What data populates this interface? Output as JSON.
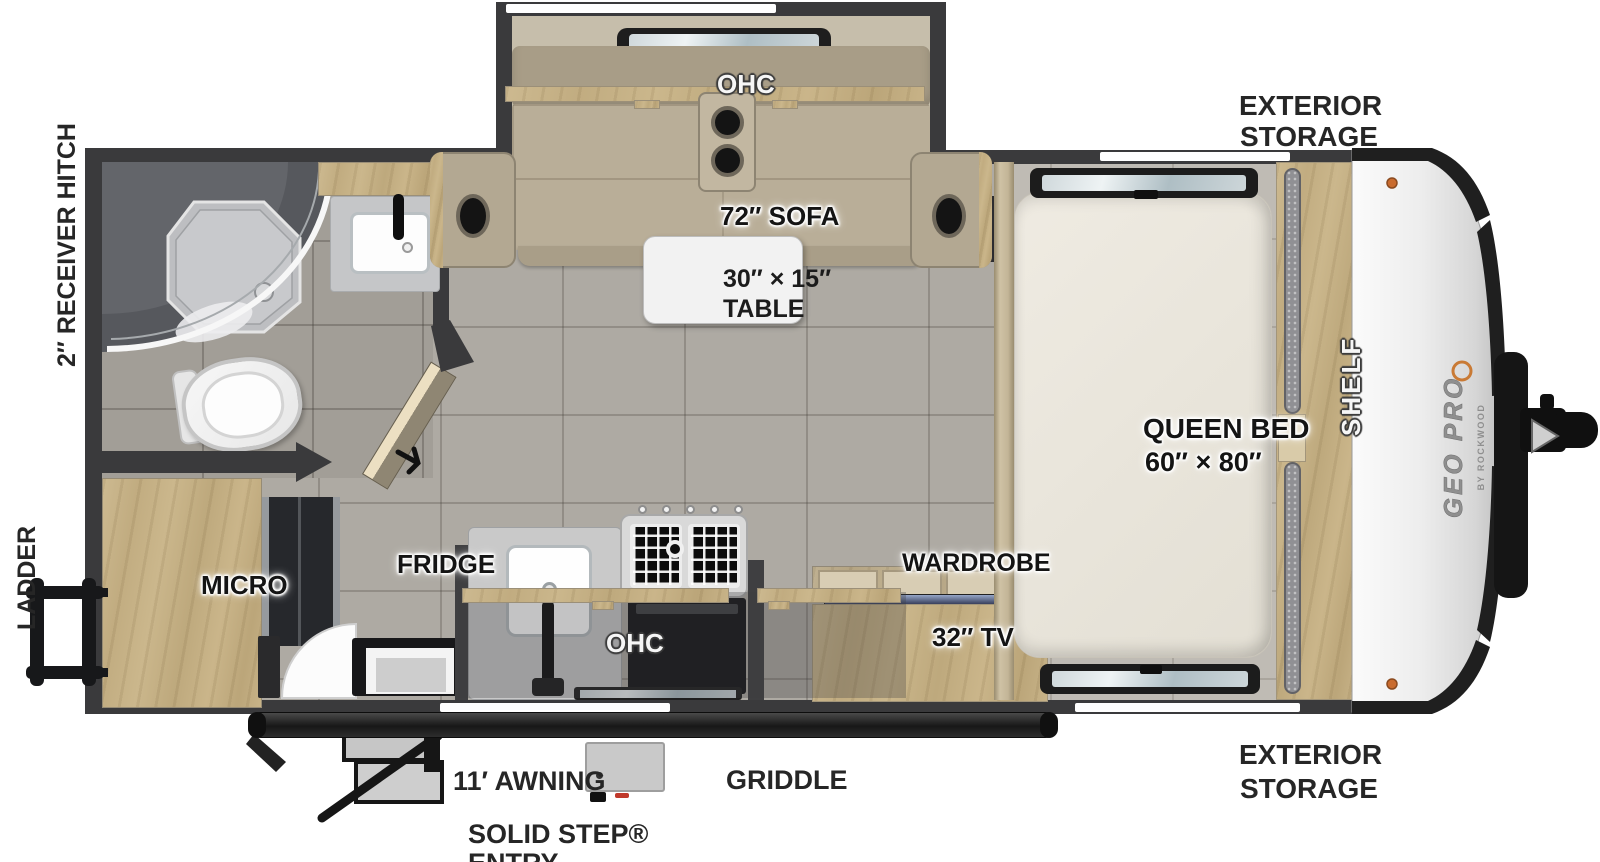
{
  "brand": {
    "name": "GEO PRO",
    "sub": "BY ROCKWOOD"
  },
  "exterior_labels": {
    "storage_top_1": "EXTERIOR",
    "storage_top_2": "STORAGE",
    "storage_bottom_1": "EXTERIOR",
    "storage_bottom_2": "STORAGE",
    "receiver_hitch": "2″ RECEIVER HITCH",
    "ladder": "LADDER",
    "awning": "11′ AWNING",
    "solid_step_1": "SOLID STEP®",
    "solid_step_2": "ENTRY",
    "griddle": "GRIDDLE"
  },
  "interior_labels": {
    "ohc_sofa": "OHC",
    "sofa": "72″ SOFA",
    "table_1": "30″ × 15″",
    "table_2": "TABLE",
    "queen_bed_1": "QUEEN BED",
    "queen_bed_2": "60″ × 80″",
    "shelf": "SHELF",
    "micro": "MICRO",
    "fridge": "FRIDGE",
    "ohc_kitchen": "OHC",
    "wardrobe": "WARDROBE",
    "tv": "32″ TV"
  },
  "colors": {
    "wall": "#3a3a3c",
    "floor": "#aeaaa3",
    "wood": "#e0d4b8",
    "sofa": "#b5aa94",
    "bed": "#eae6dd",
    "cap_silver": "#ececec",
    "accent_orange": "#c97a35",
    "label": "#141414"
  }
}
